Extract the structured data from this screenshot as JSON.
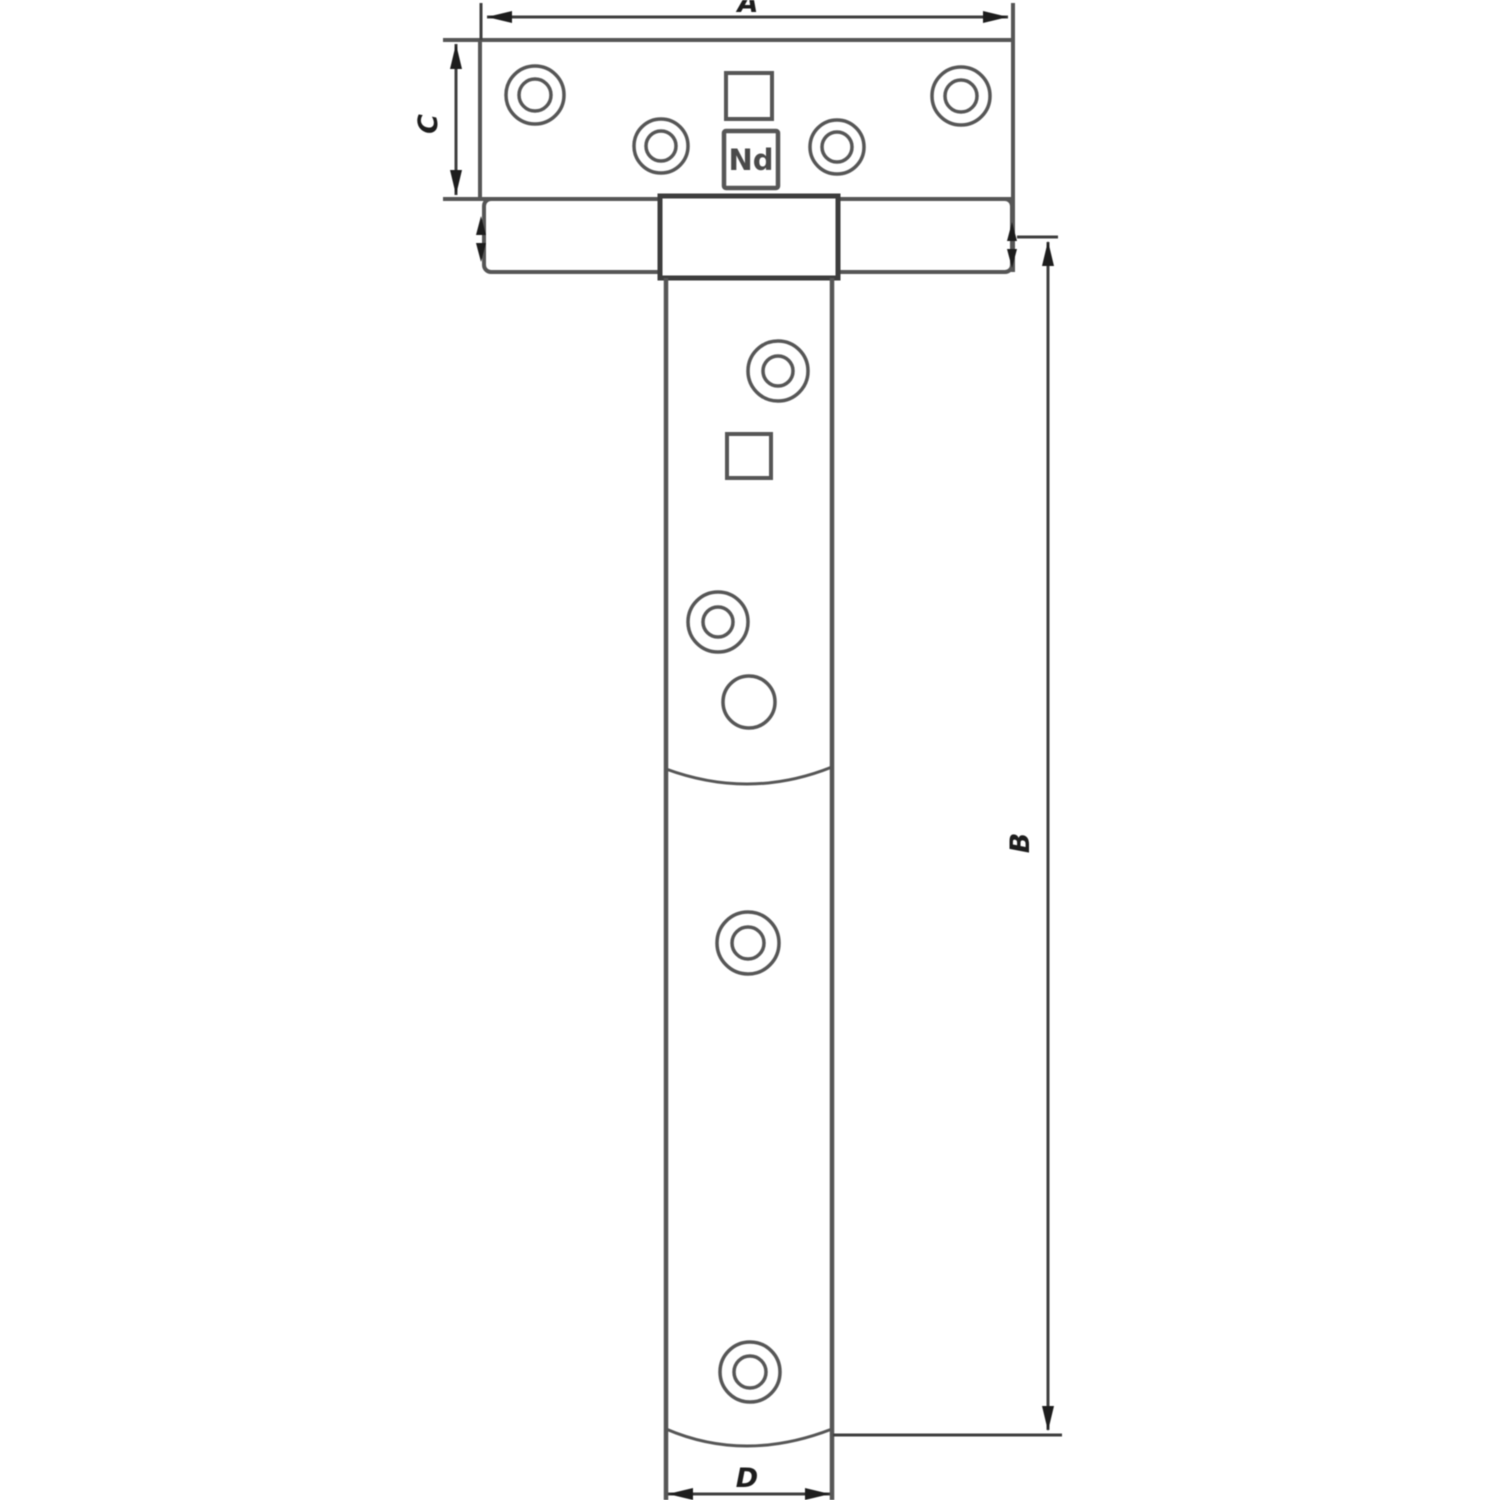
{
  "drawing": {
    "labels": {
      "dim_a": "A",
      "dim_b": "B",
      "dim_c": "C",
      "dim_d": "D",
      "brand_mark": "Nd"
    },
    "colors": {
      "background": "#ffffff",
      "outline": "#565656",
      "dimension_line": "#3f3f3f",
      "arrow": "#1d1d1d",
      "knuckle_outline": "#3d3d3d"
    }
  }
}
